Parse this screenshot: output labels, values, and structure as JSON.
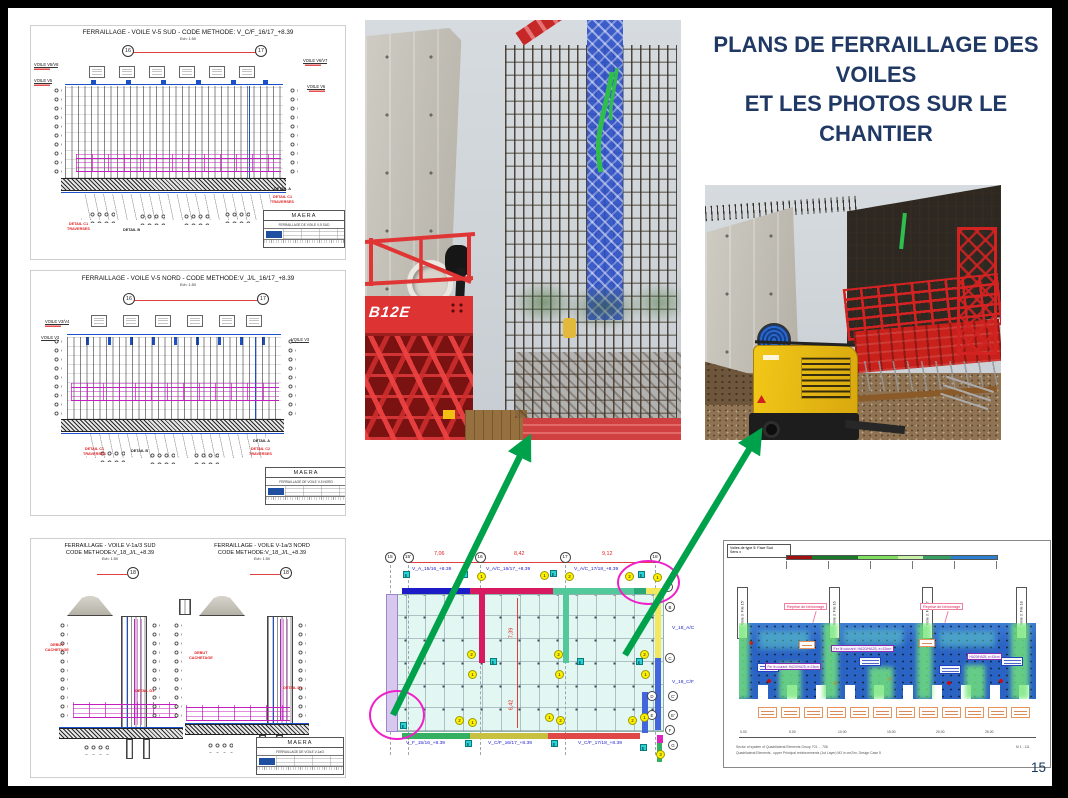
{
  "colors": {
    "title_navy": "#1F3864",
    "arrow_green": "#00A14B",
    "plan_blue_bar": "#1C1CC8",
    "plan_crimson": "#D81B60",
    "plan_green": "#52C99A",
    "plan_yellow": "#F2E860"
  },
  "slide": {
    "title_line1": "PLANS DE FERRAILLAGE DES VOILES",
    "title_line2": "ET LES PHOTOS SUR LE CHANTIER",
    "page_number": "15"
  },
  "drawing1": {
    "title": "FERRAILLAGE - VOILE V-5 SUD - CODE METHODE: V_C/F_16/17_+8.39",
    "scale": "Ech: 1:50",
    "grid_left": "16",
    "grid_right": "17",
    "label_left_top": "VOILE V5/V8",
    "label_left_bottom": "VOILE V5",
    "label_right_top": "VOILE V6/V7",
    "label_right_bottom": "VOILE V6",
    "detail_a": "DETAIL A",
    "detail_b": "DETAIL B",
    "detail_c1": "DETAIL C1",
    "traverses": "TRAVERSES",
    "block": {
      "brand": "MAERA",
      "subtitle": "FERRAILLAGE DE VOILE V-5 SUD"
    }
  },
  "drawing2": {
    "title": "FERRAILLAGE - VOILE V-5 NORD - CODE METHODE:V_J/L_16/17_+8.39",
    "scale": "Ech: 1:50",
    "grid_left": "16",
    "grid_right": "17",
    "label_left_top": "VOILE V3/V4",
    "label_left_bottom": "VOILE V3",
    "label_right": "VOILE V3",
    "detail_a": "DETAIL A",
    "detail_b": "DETAIL B",
    "detail_c1": "DETAIL C1",
    "detail_c2": "DETAIL C2",
    "traverses": "TRAVERSES",
    "block": {
      "brand": "MAERA",
      "subtitle": "FERRAILLAGE DE VOILE V-5 NORD"
    }
  },
  "drawing3": {
    "left": {
      "title1": "FERRAILLAGE - VOILE V-1a/3 SUD",
      "title2": "CODE METHODE:V_18_J/L_+8.39",
      "scale": "Ech: 1:50",
      "grid": "18",
      "detail": "DETAIL D1",
      "note1": "DEBUT",
      "note2": "CACHETAGE"
    },
    "right": {
      "title1": "FERRAILLAGE - VOILE V-1a/3 NORD",
      "title2": "CODE METHODE:V_18_J/L_+8.39",
      "scale": "Ech: 1:50",
      "grid": "18",
      "detail": "DETAIL D1",
      "note1": "DEBUT",
      "note2": "CACHETAGE"
    },
    "block": {
      "brand": "MAERA",
      "subtitle": "FERRAILLAGE DE VOILE V-1a/3"
    }
  },
  "photo1": {
    "machine_label": "B12E"
  },
  "plan": {
    "grid_top": [
      {
        "label": "15",
        "x": 14
      },
      {
        "label": "15'",
        "x": 32
      },
      {
        "label": "16",
        "x": 104
      },
      {
        "label": "17",
        "x": 189
      },
      {
        "label": "18",
        "x": 279
      }
    ],
    "grid_right": [
      {
        "label": "A",
        "x": 292,
        "y": 45
      },
      {
        "label": "B",
        "x": 294,
        "y": 65
      },
      {
        "label": "C",
        "x": 294,
        "y": 116
      },
      {
        "label": "D",
        "x": 276,
        "y": 154
      },
      {
        "label": "C'",
        "x": 297,
        "y": 154
      },
      {
        "label": "E",
        "x": 276,
        "y": 173
      },
      {
        "label": "E'",
        "x": 297,
        "y": 173
      },
      {
        "label": "F",
        "x": 294,
        "y": 188
      },
      {
        "label": "G",
        "x": 297,
        "y": 203
      }
    ],
    "dims_top": [
      {
        "label": "7,06",
        "x": 58
      },
      {
        "label": "8,42",
        "x": 138
      },
      {
        "label": "9,12",
        "x": 226
      }
    ],
    "dims_side": [
      {
        "label": "7,39",
        "y": 88
      },
      {
        "label": "6,42",
        "y": 160
      }
    ],
    "labels_top": [
      {
        "label": "V_A_15/16_+8.39",
        "x": 36
      },
      {
        "label": "V_A/C_16/17_+8.39",
        "x": 110
      },
      {
        "label": "V_A/C_17/18_+8.39",
        "x": 198
      }
    ],
    "labels_bottom": [
      {
        "label": "V_F_15/16_+8.39",
        "x": 30
      },
      {
        "label": "V_C/F_16/17_+8.39",
        "x": 112
      },
      {
        "label": "V_C/F_17/18_+8.39",
        "x": 202
      }
    ],
    "labels_right": [
      {
        "label": "V_18_A/C",
        "y": 84
      },
      {
        "label": "V_18_C/F",
        "y": 138
      }
    ],
    "markers": [
      {
        "n": "1",
        "x": 101,
        "y": 30
      },
      {
        "n": "1",
        "x": 164,
        "y": 29
      },
      {
        "n": "2",
        "x": 189,
        "y": 30
      },
      {
        "n": "2",
        "x": 249,
        "y": 30
      },
      {
        "n": "1",
        "x": 277,
        "y": 31
      },
      {
        "n": "2",
        "x": 91,
        "y": 108
      },
      {
        "n": "1",
        "x": 92,
        "y": 128
      },
      {
        "n": "2",
        "x": 178,
        "y": 108
      },
      {
        "n": "1",
        "x": 179,
        "y": 128
      },
      {
        "n": "2",
        "x": 264,
        "y": 108
      },
      {
        "n": "1",
        "x": 265,
        "y": 128
      },
      {
        "n": "2",
        "x": 79,
        "y": 174
      },
      {
        "n": "1",
        "x": 92,
        "y": 176
      },
      {
        "n": "1",
        "x": 169,
        "y": 171
      },
      {
        "n": "2",
        "x": 180,
        "y": 174
      },
      {
        "n": "2",
        "x": 252,
        "y": 174
      },
      {
        "n": "1",
        "x": 264,
        "y": 171
      },
      {
        "n": "3",
        "x": 280,
        "y": 208
      }
    ],
    "sections": [
      {
        "x": 27,
        "y": 29
      },
      {
        "x": 85,
        "y": 29
      },
      {
        "x": 174,
        "y": 28
      },
      {
        "x": 262,
        "y": 29
      },
      {
        "x": 114,
        "y": 116
      },
      {
        "x": 201,
        "y": 116
      },
      {
        "x": 260,
        "y": 116
      },
      {
        "x": 24,
        "y": 180
      },
      {
        "x": 89,
        "y": 198
      },
      {
        "x": 175,
        "y": 198
      },
      {
        "x": 264,
        "y": 202
      }
    ]
  },
  "fem": {
    "box_line1": "Voiles de type 5: Face Sud",
    "box_line2": "Sens x",
    "piles": [
      {
        "label": "Voile 3: File 15'",
        "x": 13
      },
      {
        "label": "Voile 3: File 16",
        "x": 105
      },
      {
        "label": "Voile 3: File 17",
        "x": 198
      },
      {
        "label": "Voile 3: File 18",
        "x": 292
      }
    ],
    "callout": "Reprise de bétonnage",
    "note_main": "Fer lit courant: HA20/HA25, e=15cm",
    "note_right": "HA20/HA25, e=15cm",
    "axis": [
      "0.00",
      "5.00",
      "10.00",
      "15.00",
      "20.00",
      "25.00"
    ],
    "scale_note": "M 1 : 111",
    "footnote1": "Sector of system of Quadrilateral Elements Group 701 ... 706",
    "footnote2": "Quadrilateral Elements , upper Principal reinforcements (1st Layer)      M2 in cm2/m, Design Case 5"
  }
}
